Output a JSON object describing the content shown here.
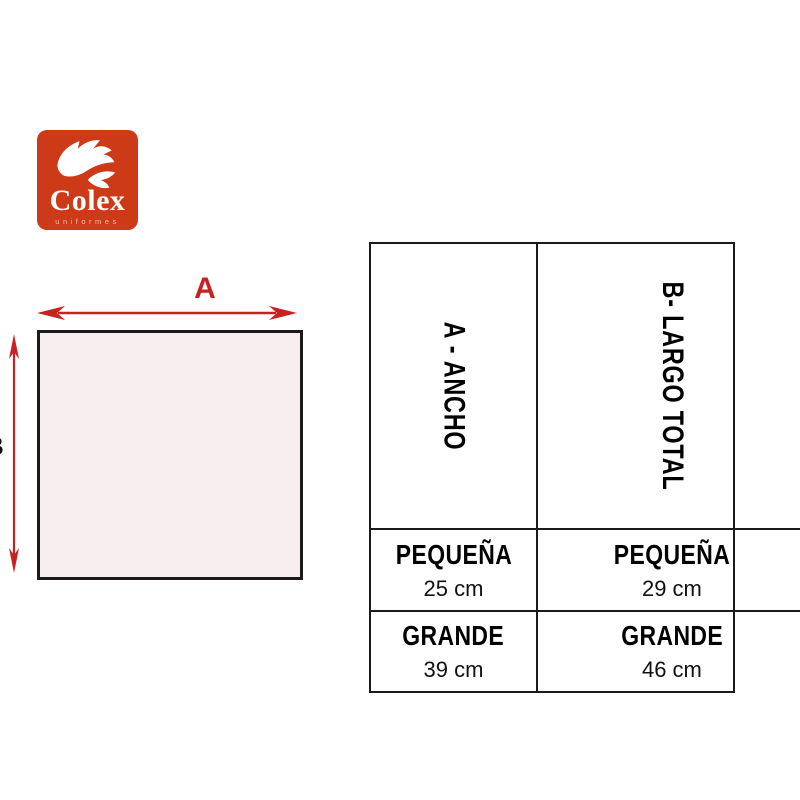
{
  "logo": {
    "brand": "Colex",
    "tagline": "uniformes",
    "background_color": "#cd3a17",
    "icon": "wing-icon"
  },
  "diagram": {
    "width_label": "A",
    "height_label": "B",
    "arrow_color": "#c82121",
    "shape_fill": "#f7ecee",
    "shape_border": "#1a1a1a"
  },
  "size_table": {
    "columns": [
      {
        "header": "A - ANCHO",
        "rows": [
          {
            "size": "PEQUEÑA",
            "value": "25 cm"
          },
          {
            "size": "GRANDE",
            "value": "39 cm"
          }
        ]
      },
      {
        "header": "B- LARGO TOTAL",
        "rows": [
          {
            "size": "PEQUEÑA",
            "value": "29 cm"
          },
          {
            "size": "GRANDE",
            "value": "46 cm"
          }
        ]
      }
    ]
  },
  "chart_data": {
    "type": "table",
    "columns": [
      "A - ANCHO",
      "B- LARGO TOTAL"
    ],
    "rows": [
      {
        "size": "PEQUEÑA",
        "A - ANCHO": "25 cm",
        "B- LARGO TOTAL": "29 cm"
      },
      {
        "size": "GRANDE",
        "A - ANCHO": "39 cm",
        "B- LARGO TOTAL": "46 cm"
      }
    ]
  }
}
